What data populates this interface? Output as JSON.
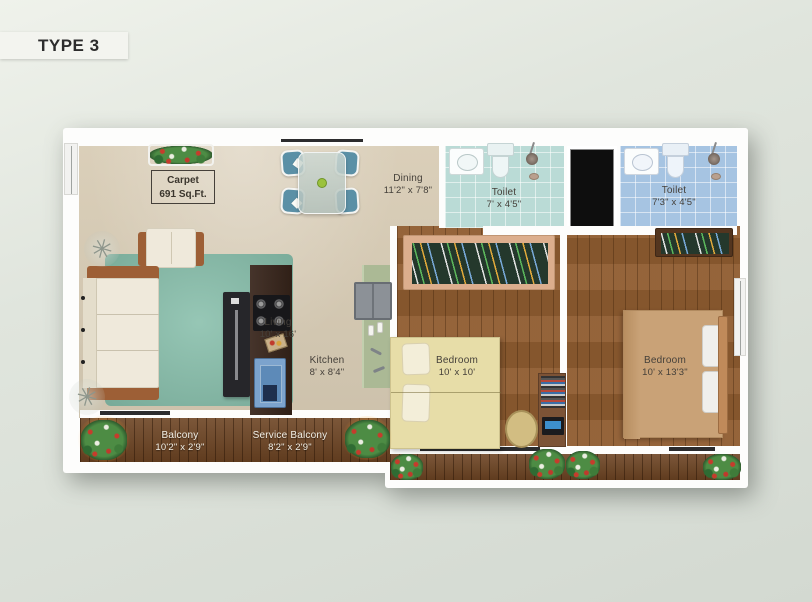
{
  "page": {
    "title": "TYPE 3"
  },
  "plan": {
    "carpet": {
      "line1": "Carpet",
      "line2": "691 Sq.Ft."
    },
    "rooms": {
      "living": {
        "name": "Living",
        "dims": "10' x 16'"
      },
      "dining": {
        "name": "Dining",
        "dims": "11'2\" x 7'8\""
      },
      "kitchen": {
        "name": "Kitchen",
        "dims": "8' x 8'4\""
      },
      "toilet1": {
        "name": "Toilet",
        "dims": "7' x 4'5\""
      },
      "toilet2": {
        "name": "Toilet",
        "dims": "7'3\" x 4'5\""
      },
      "bedroom1": {
        "name": "Bedroom",
        "dims": "10' x 10'"
      },
      "bedroom2": {
        "name": "Bedroom",
        "dims": "10' x 13'3\""
      },
      "balcony": {
        "name": "Balcony",
        "dims": "10'2\" x 2'9\""
      },
      "service_balcony": {
        "name": "Service Balcony",
        "dims": "8'2\" x 2'9\""
      }
    },
    "colors": {
      "living_floor": "#d8ccb5",
      "rug": "#85bda9",
      "bedroom_wood": "#8f5c30",
      "balcony_wood": "#6d4423",
      "toilet1_tile": "#badbd6",
      "toilet2_tile": "#a6c4e2",
      "chair_blue": "#5b90a6",
      "bed1": "#e7dda8",
      "bed2": "#c9a277",
      "kitchen_counter": "#38251b",
      "sink_cabinet": "#7ca3cd",
      "sofa_cream": "#efe9db",
      "green_counter": "#abb995",
      "shaft": "#0e0e0e"
    }
  }
}
